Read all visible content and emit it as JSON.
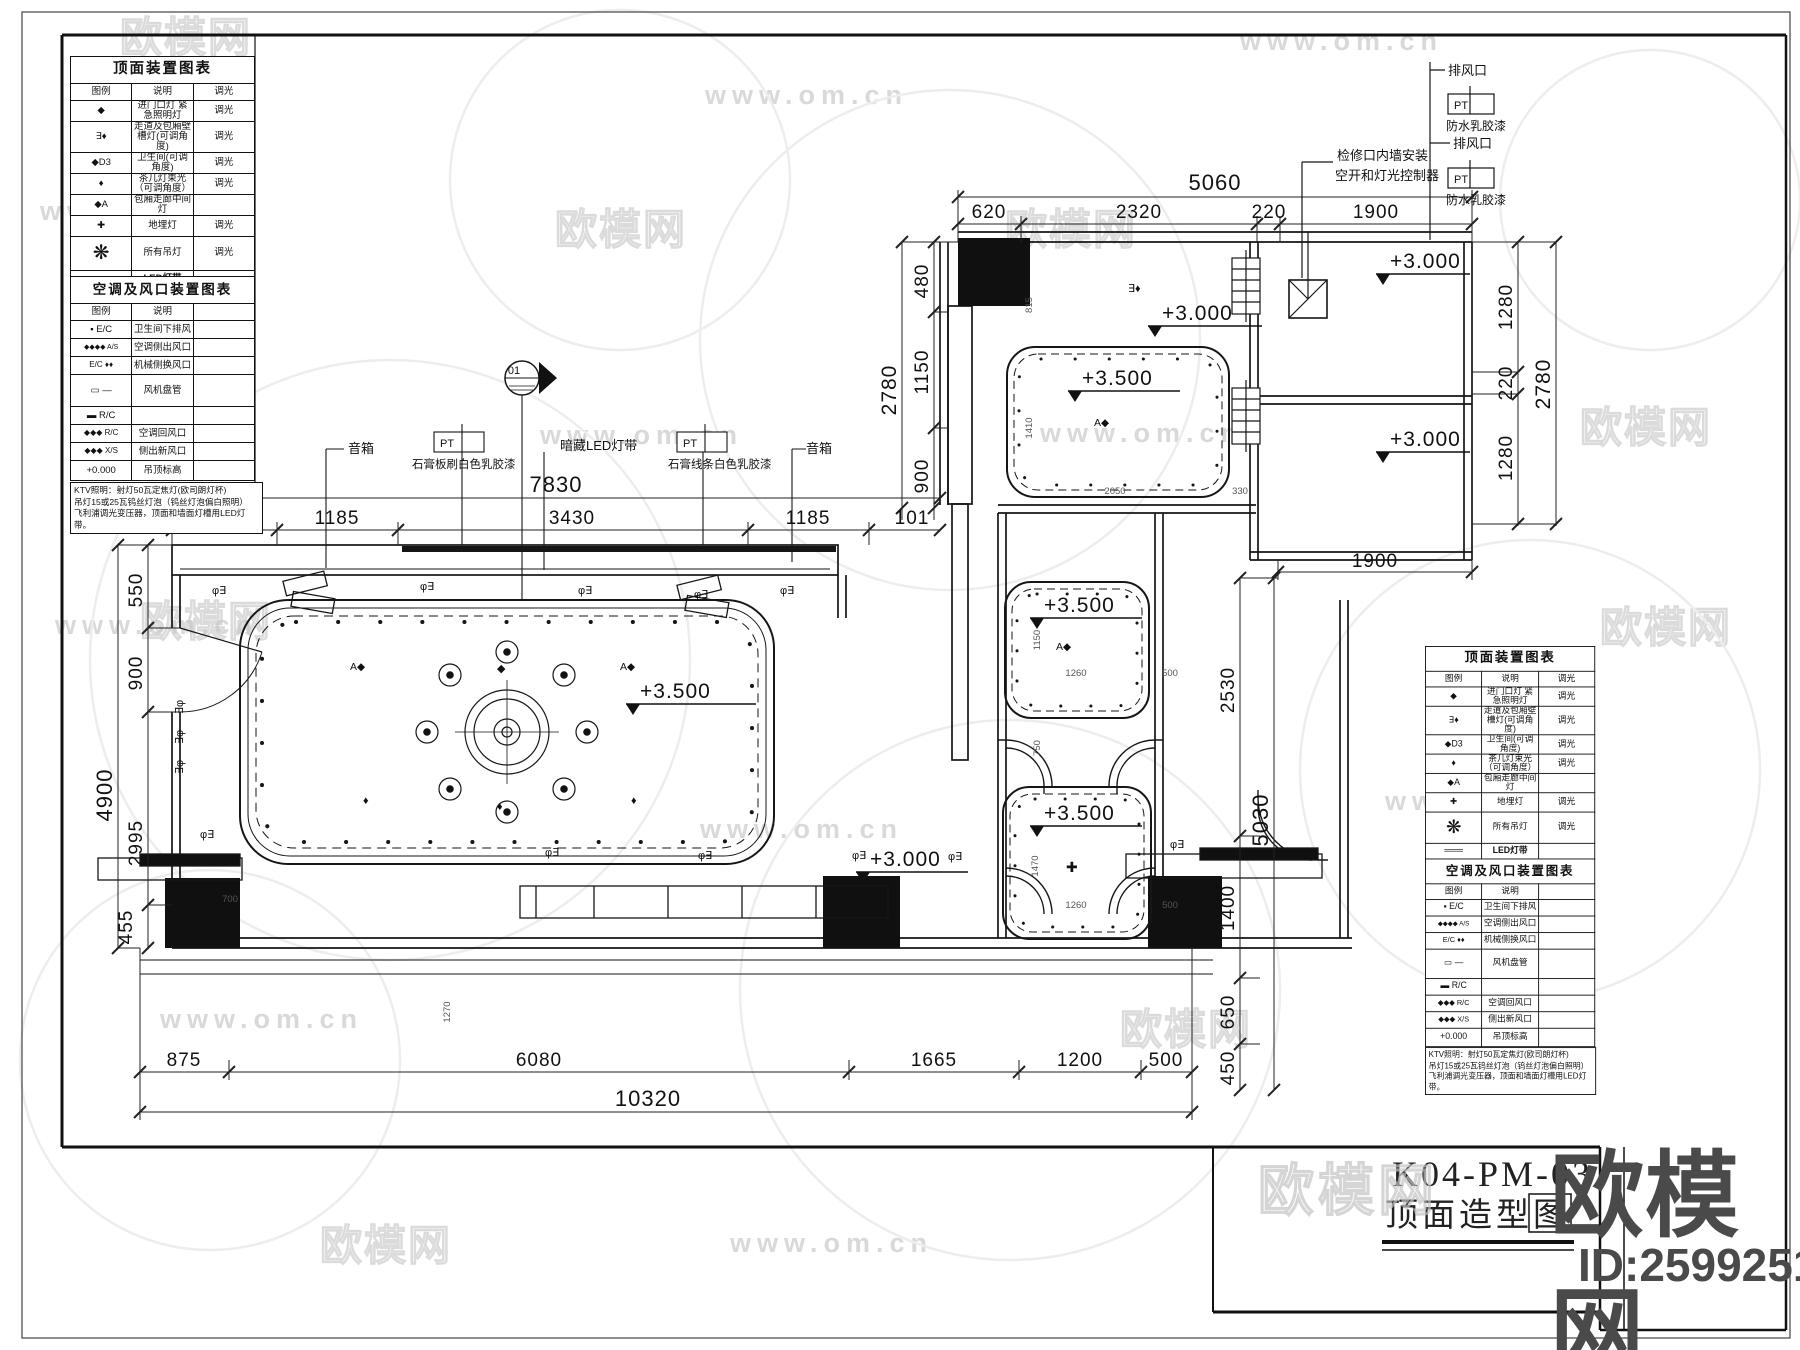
{
  "watermark": {
    "url": "www.om.cn",
    "brand": "欧模网"
  },
  "brand_footer": {
    "brand": "欧模网",
    "id": "ID:2599251"
  },
  "title_block": {
    "code": "K04-PM-03",
    "title": "顶面造型图"
  },
  "legend_light": {
    "title": "顶面装置图表",
    "headers": [
      "图例",
      "说明",
      "调光"
    ],
    "rows": [
      {
        "symbol": "◆",
        "desc": "进门口灯 紧急照明灯",
        "dim": "调光"
      },
      {
        "symbol": "∃♦",
        "desc": "走道及包厢壁槽灯(可调角度)",
        "dim": "调光"
      },
      {
        "symbol": "◆D3",
        "desc": "卫生间(可调角度)",
        "dim": "调光"
      },
      {
        "symbol": "♦",
        "desc": "茶几灯束光（可调角度）",
        "dim": "调光"
      },
      {
        "symbol": "◆A",
        "desc": "包厢走廊中间灯",
        "dim": ""
      },
      {
        "symbol": "✚",
        "desc": "地埋灯",
        "dim": "调光"
      },
      {
        "symbol": "❋",
        "desc": "所有吊灯",
        "dim": "调光"
      },
      {
        "symbol": "═══",
        "desc": "LED灯带",
        "dim": ""
      }
    ]
  },
  "legend_hvac": {
    "title": "空调及风口装置图表",
    "headers": [
      "图例",
      "说明"
    ],
    "rows": [
      {
        "symbol": "▪ E/C",
        "desc": "卫生间下排风"
      },
      {
        "symbol": "◆◆◆◆ A/S",
        "desc": "空调侧出风口"
      },
      {
        "symbol": "E/C ♦♦",
        "desc": "机械侧换风口"
      },
      {
        "symbol": "▭ —",
        "desc": "风机盘管"
      },
      {
        "symbol": "▬ R/C",
        "desc": ""
      },
      {
        "symbol": "◆◆◆ R/C",
        "desc": "空调回风口"
      },
      {
        "symbol": "◆◆◆ X/S",
        "desc": "侧出新风口"
      },
      {
        "symbol": "+0.000",
        "desc": "吊顶标高"
      }
    ]
  },
  "notes": [
    "KTV照明：射灯50瓦定焦灯(欧司朗灯杯)",
    "吊灯15或25瓦钨丝灯泡（钨丝灯泡偏白照明）",
    "飞利浦调光变压器，顶面和墙面灯槽用LED灯带。"
  ],
  "annotations": {
    "speaker": "音箱",
    "speaker2": "音箱",
    "led_strip": "暗藏LED灯带",
    "gypsum_board": "石膏板刷白色乳胶漆",
    "gypsum_trim": "石膏线条白色乳胶漆",
    "pt": "PT",
    "exhaust1": "排风口",
    "exhaust2": "排风口",
    "waterproof1": "防水乳胶漆",
    "waterproof2": "防水乳胶漆",
    "access_line1": "检修口内墙安装",
    "access_line2": "空开和灯光控制器",
    "marker": "01"
  },
  "elevations": {
    "main": "+3.500",
    "room_a": "+3.500",
    "cove2": "+3.500",
    "cove3": "+3.500",
    "corridor": "+3.000",
    "right_top": "+3.000",
    "right_bottom": "+3.000",
    "main_low": "+3.000"
  },
  "symbols": {
    "wall_lamp": "φ∃",
    "wall_lamp_r": "∃φ",
    "aim_lamp": "A◆",
    "spot": "◆",
    "small_spot": "♦",
    "ground_lamp": "✚",
    "wall_slot": "∃♦"
  },
  "dims": {
    "top_total": "5060",
    "top": [
      "620",
      "2320",
      "220",
      "1900"
    ],
    "upper_total": "7830",
    "upper": [
      "1015",
      "1185",
      "3430",
      "1185",
      "101"
    ],
    "left_total": "4900",
    "left": [
      "550",
      "900",
      "2995",
      "455"
    ],
    "corridor_total": "2780",
    "corridor": [
      "480",
      "1150",
      "900"
    ],
    "right_total": "5030",
    "right": [
      "2530",
      "1400",
      "650",
      "450"
    ],
    "right_rooms_width": "1900",
    "far_right_total": "2780",
    "far_right": [
      "1280",
      "220",
      "1280"
    ],
    "bottom_total": "10320",
    "bottom": [
      "875",
      "6080",
      "1665",
      "1200",
      "500"
    ],
    "minor": [
      "815",
      "1410",
      "2050",
      "330",
      "1150",
      "1260",
      "500",
      "750",
      "1470",
      "1260",
      "500",
      "700",
      "1270"
    ]
  }
}
